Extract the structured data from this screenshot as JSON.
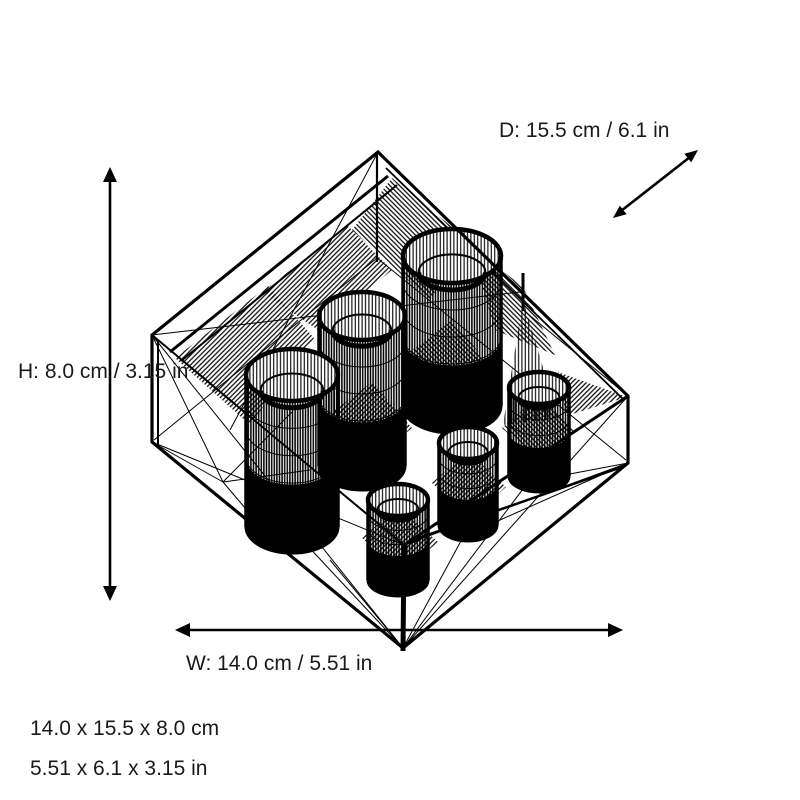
{
  "figure": {
    "description": "Black 3D wireframe mesh of a rectangular holder with two stepped rows of three cylindrical cups, shown with dimension arrows"
  },
  "colors": {
    "background": "#ffffff",
    "line": "#000000",
    "text": "#1a1a1a"
  },
  "dimension_annotations": {
    "depth_label": "D: 15.5 cm / 6.1 in",
    "height_label": "H: 8.0 cm / 3.15 in",
    "width_label": "W: 14.0 cm / 5.51 in"
  },
  "size_summary": {
    "metric": "14.0 x 15.5 x 8.0 cm",
    "imperial": "5.51 x 6.1 x 3.15 in"
  }
}
